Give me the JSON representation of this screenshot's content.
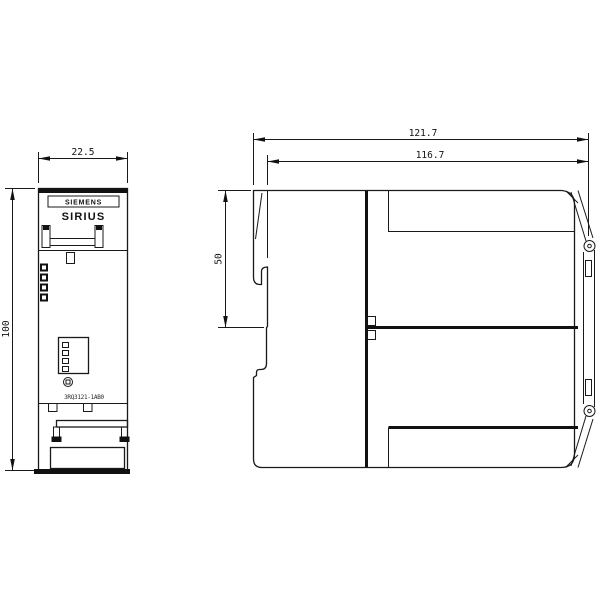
{
  "drawing": {
    "colors": {
      "line": "#1a1a1a",
      "background": "#ffffff"
    },
    "front_view": {
      "brand_label": "SIEMENS",
      "product_label": "SIRIUS",
      "order_number": "3RQ3121-1AB0",
      "width_dim": "22.5",
      "height_dim": "100",
      "led_count": 4,
      "dip_switch_count": 4
    },
    "side_view": {
      "overall_depth_dim": "121.7",
      "body_depth_dim": "116.7",
      "din_rail_section_dim": "50"
    }
  }
}
